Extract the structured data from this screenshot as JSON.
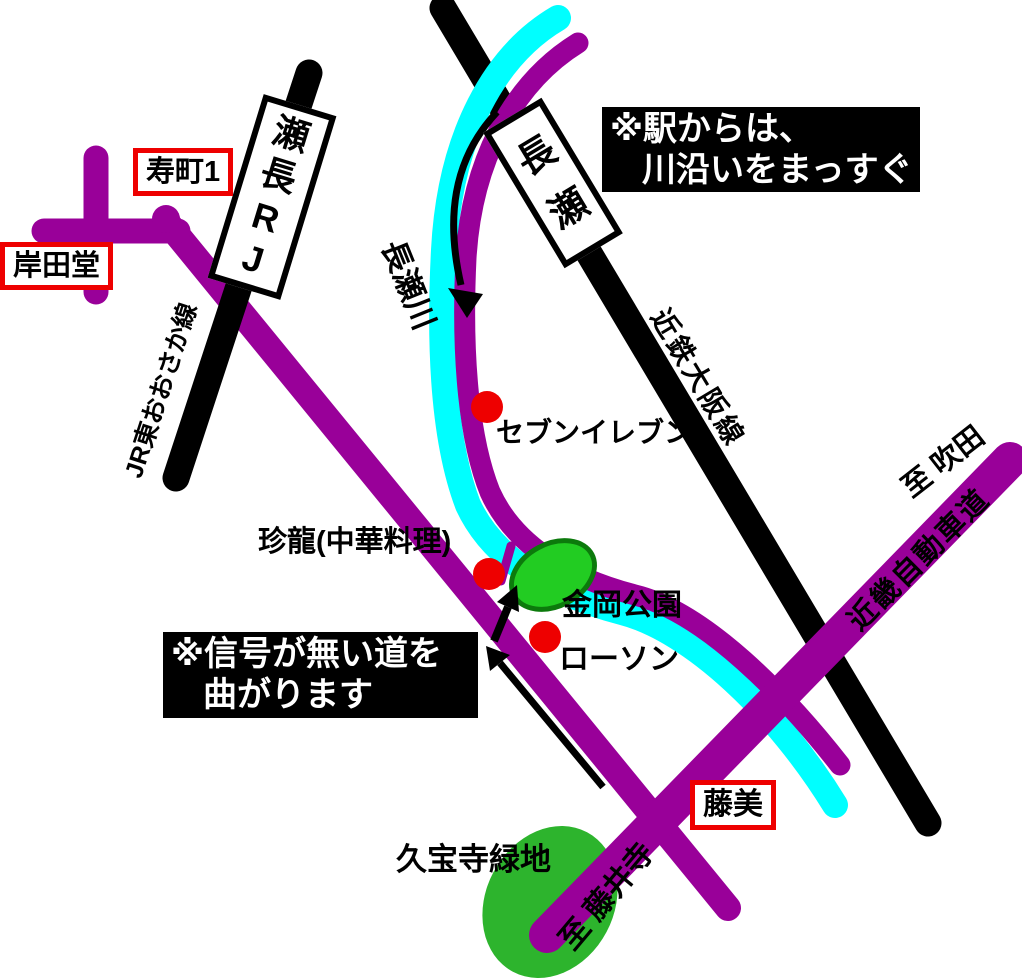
{
  "map": {
    "notes": {
      "from_station": {
        "line1": "※駅からは、",
        "line2": "川沿いをまっすぐ"
      },
      "turn": {
        "line1": "※信号が無い道を",
        "line2": "曲がります"
      }
    },
    "stations": {
      "jr_nagase": "JR長瀬",
      "nagase": "長瀬"
    },
    "rail_lines": {
      "jr_higashi_osaka": "JR東おおさか線",
      "kintetsu_osaka": "近鉄大阪線"
    },
    "river": {
      "nagase_river": "長瀬川"
    },
    "roads": {
      "kinki_expressway": "近畿自動車道",
      "to_suita": "至 吹田",
      "to_fujiidera": "至 藤井寺"
    },
    "intersections": {
      "kotobukicho1": "寿町1",
      "kishidado": "岸田堂",
      "fujimi": "藤美"
    },
    "landmarks": {
      "seven_eleven": "セブンイレブン",
      "chinryu": "珍龍(中華料理)",
      "kanaoka_park": "金岡公園",
      "lawson": "ローソン",
      "kyuhoji_ryokuchi": "久宝寺緑地"
    },
    "colors": {
      "road_purple": "#990099",
      "river_cyan": "#00FFFF",
      "rail_black": "#000000",
      "park_green": "#22CC22",
      "park_border_green": "#0C7A0C",
      "park2_green": "#2DB42D",
      "marker_red": "#EE0000",
      "label_border_red": "#EE0000",
      "arrow_black": "#000000"
    }
  }
}
